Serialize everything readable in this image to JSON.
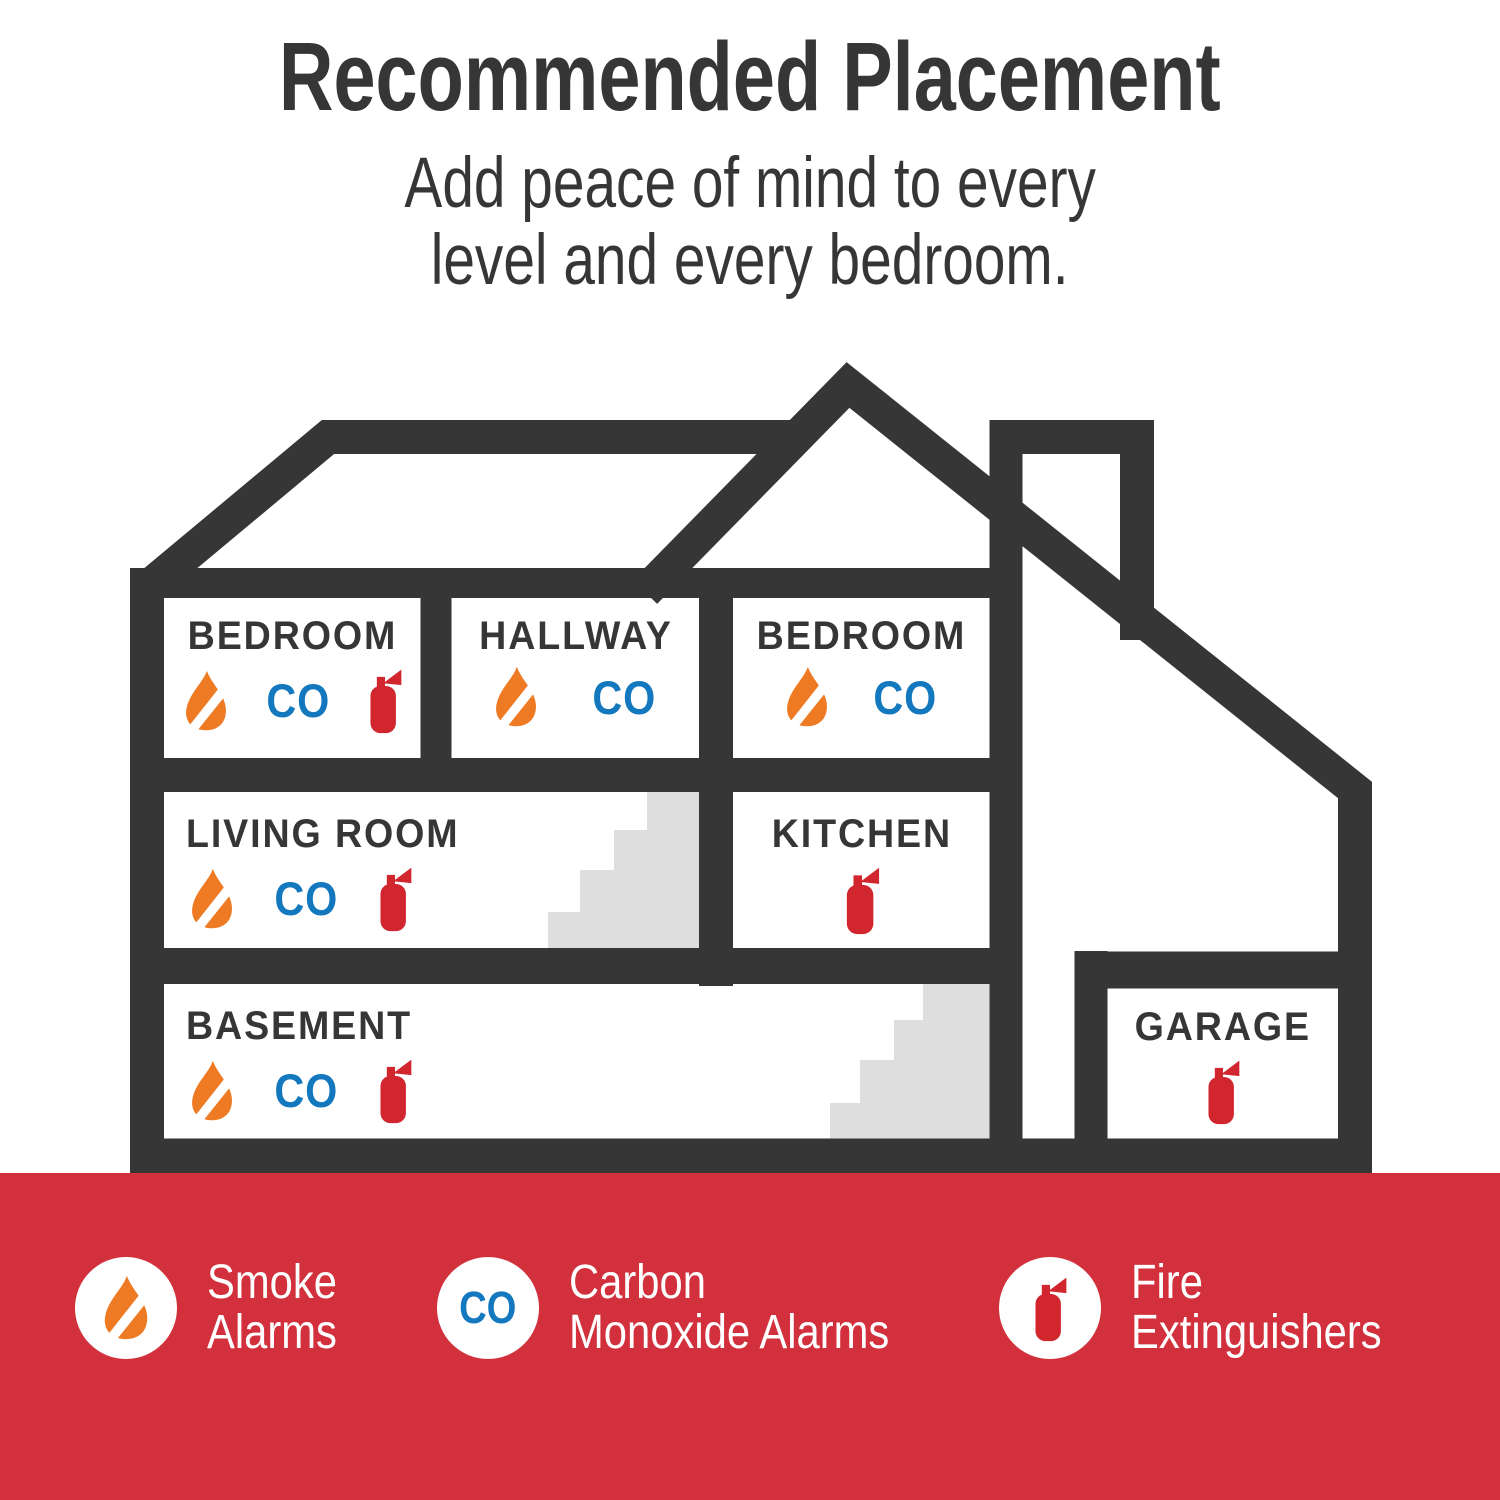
{
  "title": "Recommended Placement",
  "subtitle_line1": "Add peace of mind to every",
  "subtitle_line2": "level and every bedroom.",
  "co_label": "CO",
  "rooms": [
    {
      "id": "bedroom-1",
      "label": "BEDROOM",
      "devices": [
        "smoke-alarm",
        "co-alarm",
        "fire-extinguisher"
      ]
    },
    {
      "id": "hallway",
      "label": "HALLWAY",
      "devices": [
        "smoke-alarm",
        "co-alarm"
      ]
    },
    {
      "id": "bedroom-2",
      "label": "BEDROOM",
      "devices": [
        "smoke-alarm",
        "co-alarm"
      ]
    },
    {
      "id": "living-room",
      "label": "LIVING ROOM",
      "devices": [
        "smoke-alarm",
        "co-alarm",
        "fire-extinguisher"
      ]
    },
    {
      "id": "kitchen",
      "label": "KITCHEN",
      "devices": [
        "fire-extinguisher"
      ]
    },
    {
      "id": "basement",
      "label": "BASEMENT",
      "devices": [
        "smoke-alarm",
        "co-alarm",
        "fire-extinguisher"
      ]
    },
    {
      "id": "garage",
      "label": "GARAGE",
      "devices": [
        "fire-extinguisher"
      ]
    }
  ],
  "legend": [
    {
      "icon": "smoke-alarm-icon",
      "line1": "Smoke",
      "line2": "Alarms"
    },
    {
      "icon": "carbon-monoxide-icon",
      "line1": "Carbon",
      "line2": "Monoxide Alarms"
    },
    {
      "icon": "fire-extinguisher-icon",
      "line1": "Fire",
      "line2": "Extinguishers"
    }
  ],
  "colors": {
    "structure_dark": "#363636",
    "footer_red": "#D2303C",
    "flame_orange": "#EE7A23",
    "co_blue": "#1478BE",
    "extinguisher_red": "#D2262F",
    "stairs_gray": "#DEDEDE"
  }
}
